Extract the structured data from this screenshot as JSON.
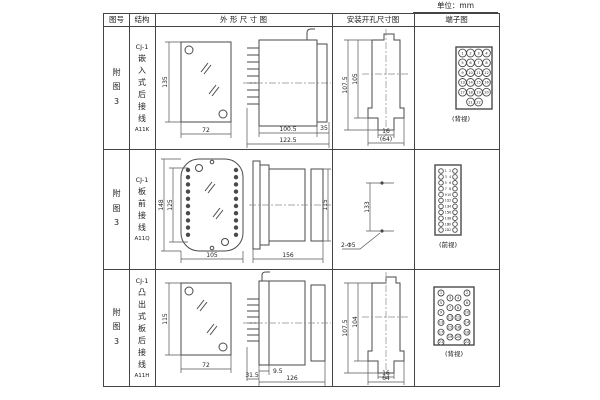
{
  "unit": "单位：mm",
  "header": {
    "fig": "图号",
    "structure": "结构",
    "outline": "外 形 尺 寸 图",
    "install": "安装开孔尺寸图",
    "terminal": "端子图"
  },
  "rows": [
    {
      "fig": "附图3",
      "model": "CJ-1",
      "desc": "嵌入式后接线",
      "code": "A11K"
    },
    {
      "fig": "附图3",
      "model": "CJ-1",
      "desc": "板前接线",
      "code": "A11Q"
    },
    {
      "fig": "附图3",
      "model": "CJ-1",
      "desc": "凸出式板后接线",
      "code": "A11H"
    }
  ],
  "dimensions": {
    "row1_outline": {
      "front_height": "135",
      "front_width": "72",
      "case_depth": "100.5",
      "total_depth": "122.5",
      "flange_depth": "35"
    },
    "row1_install": {
      "outer_height": "107.5",
      "inner_height": "105",
      "slot_width": "16",
      "opening_width": "(64)"
    },
    "row2_outline": {
      "front_height": "148",
      "inner_height": "125",
      "front_width": "105",
      "total_depth": "156",
      "case_height": "115"
    },
    "row2_install": {
      "hole_pitch": "133",
      "hole_spec": "2-Φ5"
    },
    "row3_outline": {
      "front_height": "115",
      "front_width": "72",
      "stud_length": "31.5",
      "offset": "9.5",
      "case_depth": "126"
    },
    "row3_install": {
      "outer_height": "107.5",
      "inner_height": "104",
      "slot_width": "16",
      "opening_width": "64"
    }
  },
  "terminals": {
    "row1": {
      "label": "(背视)",
      "rows": [
        [
          1,
          2,
          3,
          4
        ],
        [
          5,
          6,
          7,
          8
        ],
        [
          9,
          10,
          11,
          12
        ],
        [
          13,
          14,
          15,
          16
        ],
        [
          17,
          18,
          19,
          20
        ],
        [
          21,
          22
        ]
      ]
    },
    "row2": {
      "label": "(前视)",
      "left": [
        1,
        3,
        5,
        7,
        9,
        11,
        13,
        15,
        17,
        19,
        21
      ],
      "right": [
        2,
        4,
        6,
        8,
        10,
        12,
        14,
        16,
        18,
        20,
        22
      ]
    },
    "row3": {
      "label": "(背视)",
      "rows": [
        [
          1,
          2
        ],
        [
          3,
          4
        ],
        [
          5,
          6
        ],
        [
          7,
          8
        ],
        [
          9,
          10
        ],
        [
          11,
          12
        ],
        [
          13,
          14
        ],
        [
          15,
          16
        ],
        [
          17,
          18
        ],
        [
          19,
          20
        ],
        [
          21,
          22
        ]
      ]
    }
  }
}
